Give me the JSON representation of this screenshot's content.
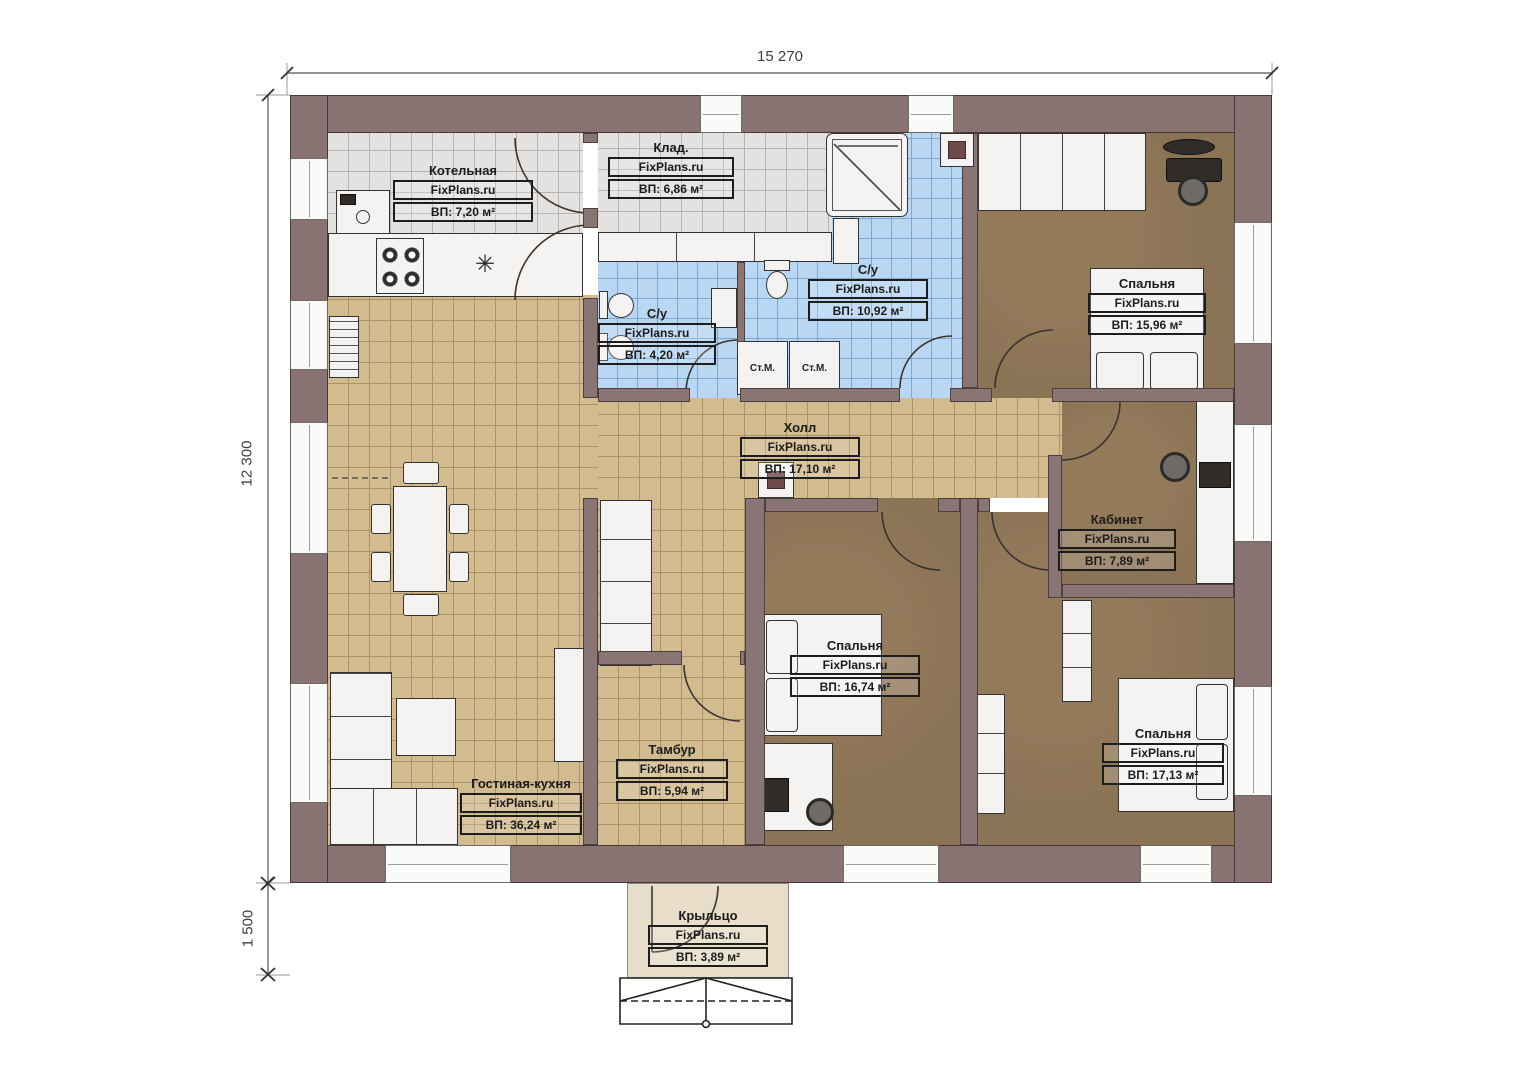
{
  "watermark": "FixPlans.ru",
  "dimensions": {
    "total_width": "15 270",
    "total_height": "12 300",
    "porch_depth": "1 500"
  },
  "rooms": [
    {
      "id": "kotelnaya",
      "name": "Котельная",
      "area": "ВП: 7,20 м²"
    },
    {
      "id": "klad",
      "name": "Клад.",
      "area": "ВП: 6,86 м²"
    },
    {
      "id": "su_big",
      "name": "С/у",
      "area": "ВП: 10,92 м²"
    },
    {
      "id": "su_small",
      "name": "С/у",
      "area": "ВП: 4,20 м²"
    },
    {
      "id": "bedroom_tr",
      "name": "Спальня",
      "area": "ВП: 15,96 м²"
    },
    {
      "id": "hall",
      "name": "Холл",
      "area": "ВП: 17,10 м²"
    },
    {
      "id": "kabinet",
      "name": "Кабинет",
      "area": "ВП: 7,89 м²"
    },
    {
      "id": "bedroom_c",
      "name": "Спальня",
      "area": "ВП: 16,74 м²"
    },
    {
      "id": "bedroom_br",
      "name": "Спальня",
      "area": "ВП: 17,13 м²"
    },
    {
      "id": "tambur",
      "name": "Тамбур",
      "area": "ВП: 5,94 м²"
    },
    {
      "id": "living",
      "name": "Гостиная-кухня",
      "area": "ВП: 36,24 м²"
    },
    {
      "id": "porch",
      "name": "Крыльцо",
      "area": "ВП: 3,89 м²"
    }
  ],
  "appliances": {
    "washer": "Ст.М."
  },
  "icons": {
    "snowflake": "✳"
  },
  "colors": {
    "wall": "#8a7575",
    "tile_gray": "#e3e2e0",
    "tile_blue": "#b9d6f2",
    "tile_tan": "#d2bb8e",
    "floor_brown": "#8b7355",
    "porch": "#e7ddc8"
  }
}
